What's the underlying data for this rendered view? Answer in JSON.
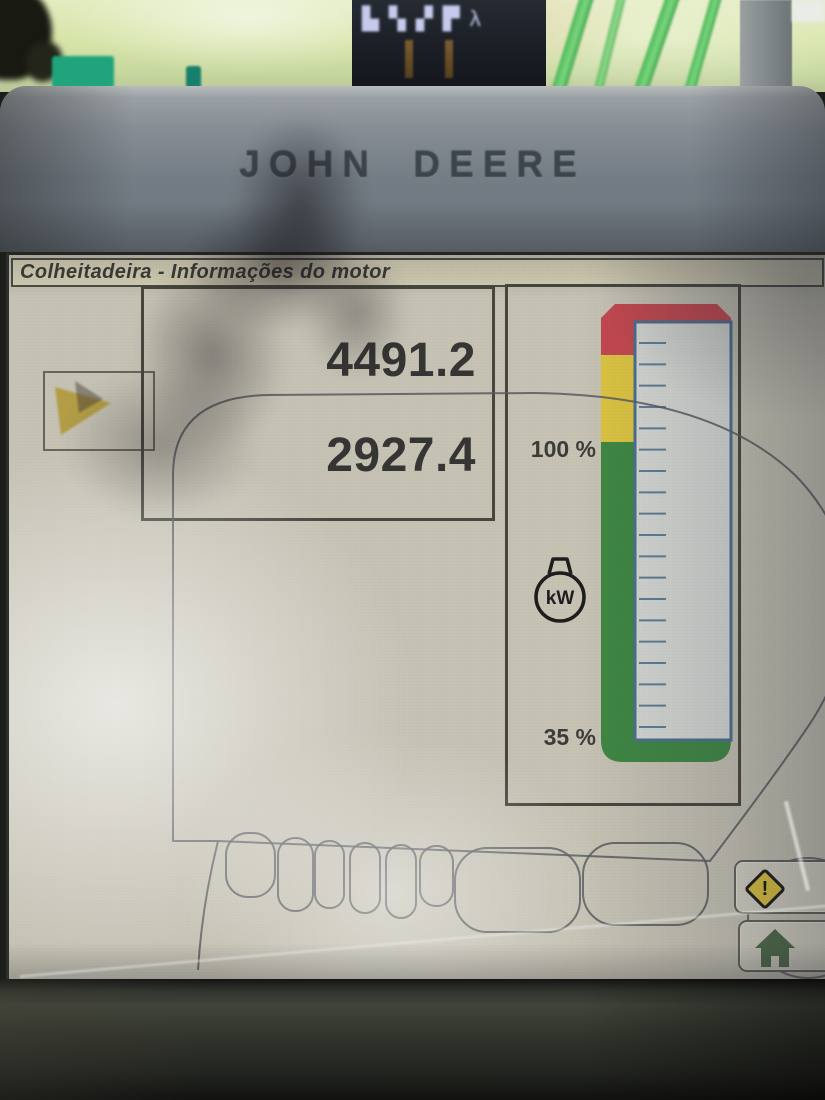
{
  "cab_scene": {
    "corner_display_glyphs": [
      "▙▚",
      "▞▛",
      "λ"
    ]
  },
  "bezel": {
    "brand": "JOHN DEERE"
  },
  "screen": {
    "title": "Colheitadeira - Informações do motor",
    "readout_panel": {
      "value_top": "4491.2",
      "value_bottom": "2927.4"
    },
    "gauge_panel": {
      "label_upper": "100 %",
      "label_lower": "35 %",
      "unit_icon_label": "kW"
    },
    "buttons": {
      "warning_glyph": "!"
    }
  },
  "colors": {
    "title_bg": "#d6d1b6",
    "panel_border": "#46463e",
    "gauge_red": "#c4474e",
    "gauge_yellow": "#ddc440",
    "gauge_green": "#3e8742",
    "gauge_track_bg": "#d6d8d4",
    "gauge_track_border": "#4a708e",
    "home_green": "#4d6b46",
    "warn_yellow": "#dcc33c"
  },
  "chart_data": {
    "type": "gauge",
    "orientation": "vertical",
    "unit": "kW",
    "title": "Engine power gauge",
    "scale_labels": [
      {
        "label": "100 %",
        "position": "at yellow/green zone boundary"
      },
      {
        "label": "35 %",
        "position": "at scale bottom"
      }
    ],
    "zones_top_to_bottom": [
      {
        "name": "red",
        "color": "#c4474e",
        "fraction": 0.11
      },
      {
        "name": "yellow",
        "color": "#ddc440",
        "fraction": 0.19
      },
      {
        "name": "green",
        "color": "#3e8742",
        "fraction": 0.7
      }
    ],
    "tick_count": 19,
    "bar_fill": null,
    "readouts": [
      4491.2,
      2927.4
    ]
  }
}
